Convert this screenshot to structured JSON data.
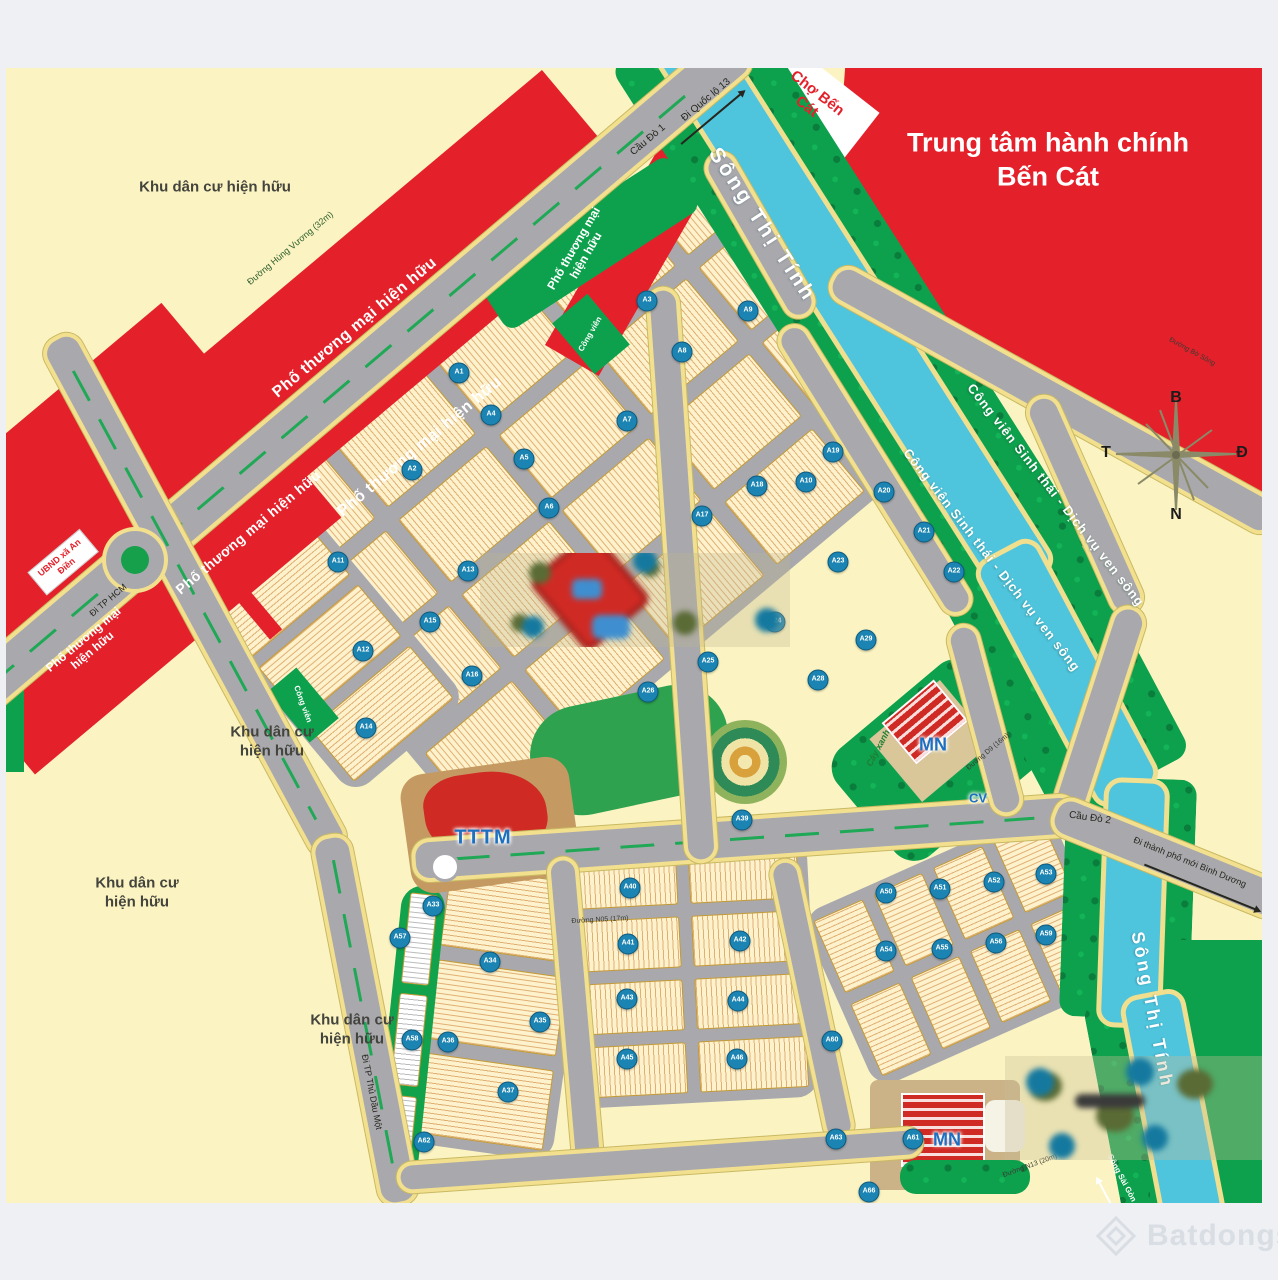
{
  "title": "Trung tâm hành chính Bến Cát",
  "labels": {
    "cho_ben_cat": "Chợ Bến Cát",
    "song_thi_tinh": "Sông Thị Tính",
    "song_sai_gon": "Sông Sài Gòn",
    "cong_vien_sinh_thai": "Công viên Sinh thái - Dịch vụ ven sông",
    "khu_dan_cu": "Khu dân cư hiện hữu",
    "pho_thuong_mai": "Phố thương mại hiện hữu",
    "ubnd": "UBND xã An Điền",
    "cong_vien": "Công viên",
    "cay_xanh": "Cây xanh",
    "tttm": "TTTM",
    "mn": "MN",
    "cv": "CV"
  },
  "roads": {
    "cau_do_1": "Cầu Đò 1",
    "di_quoc_lo_13": "Đi Quốc lộ 13",
    "cau_do_2": "Cầu Đò 2",
    "di_tpm_binh_duong": "Đi thành phố mới Bình Dương",
    "di_tp_hcm": "Đi TP HCM",
    "di_tp_thu_dau_mot": "Đi TP Thủ Dầu Một",
    "hung_vuong": "Đường Hùng Vương (32m)",
    "bo_song": "Đường Bờ Sông",
    "n05": "Đường N05 (17m)",
    "n13": "Đường N13 (20m)",
    "d9": "Đường D9 (16m)"
  },
  "compass": {
    "north": "B",
    "east": "Đ",
    "south": "N",
    "west": "T"
  },
  "watermark": "Batdongsan",
  "markers": [
    {
      "label": "A1",
      "x": 459,
      "y": 373
    },
    {
      "label": "A2",
      "x": 412,
      "y": 470
    },
    {
      "label": "A3",
      "x": 647,
      "y": 301
    },
    {
      "label": "A4",
      "x": 491,
      "y": 415
    },
    {
      "label": "A5",
      "x": 524,
      "y": 459
    },
    {
      "label": "A6",
      "x": 549,
      "y": 508
    },
    {
      "label": "A7",
      "x": 627,
      "y": 421
    },
    {
      "label": "A8",
      "x": 682,
      "y": 352
    },
    {
      "label": "A9",
      "x": 748,
      "y": 311
    },
    {
      "label": "A10",
      "x": 806,
      "y": 482
    },
    {
      "label": "A11",
      "x": 338,
      "y": 562
    },
    {
      "label": "A12",
      "x": 363,
      "y": 651
    },
    {
      "label": "A13",
      "x": 468,
      "y": 571
    },
    {
      "label": "A14",
      "x": 366,
      "y": 728
    },
    {
      "label": "A15",
      "x": 430,
      "y": 622
    },
    {
      "label": "A16",
      "x": 472,
      "y": 676
    },
    {
      "label": "A17",
      "x": 702,
      "y": 516
    },
    {
      "label": "A18",
      "x": 757,
      "y": 486
    },
    {
      "label": "A19",
      "x": 833,
      "y": 452
    },
    {
      "label": "A20",
      "x": 884,
      "y": 492
    },
    {
      "label": "A21",
      "x": 924,
      "y": 532
    },
    {
      "label": "A22",
      "x": 954,
      "y": 572
    },
    {
      "label": "A23",
      "x": 838,
      "y": 562
    },
    {
      "label": "A24",
      "x": 775,
      "y": 622
    },
    {
      "label": "A25",
      "x": 708,
      "y": 662
    },
    {
      "label": "A26",
      "x": 648,
      "y": 692
    },
    {
      "label": "A28",
      "x": 818,
      "y": 680
    },
    {
      "label": "A29",
      "x": 866,
      "y": 640
    },
    {
      "label": "A33",
      "x": 433,
      "y": 906
    },
    {
      "label": "A34",
      "x": 490,
      "y": 962
    },
    {
      "label": "A35",
      "x": 540,
      "y": 1022
    },
    {
      "label": "A36",
      "x": 448,
      "y": 1042
    },
    {
      "label": "A37",
      "x": 508,
      "y": 1092
    },
    {
      "label": "A39",
      "x": 742,
      "y": 820
    },
    {
      "label": "A40",
      "x": 630,
      "y": 888
    },
    {
      "label": "A41",
      "x": 628,
      "y": 944
    },
    {
      "label": "A42",
      "x": 740,
      "y": 941
    },
    {
      "label": "A43",
      "x": 627,
      "y": 999
    },
    {
      "label": "A44",
      "x": 738,
      "y": 1001
    },
    {
      "label": "A45",
      "x": 627,
      "y": 1059
    },
    {
      "label": "A46",
      "x": 737,
      "y": 1059
    },
    {
      "label": "A50",
      "x": 886,
      "y": 893
    },
    {
      "label": "A51",
      "x": 940,
      "y": 889
    },
    {
      "label": "A52",
      "x": 994,
      "y": 882
    },
    {
      "label": "A53",
      "x": 1046,
      "y": 874
    },
    {
      "label": "A54",
      "x": 886,
      "y": 951
    },
    {
      "label": "A55",
      "x": 942,
      "y": 949
    },
    {
      "label": "A56",
      "x": 996,
      "y": 943
    },
    {
      "label": "A59",
      "x": 1046,
      "y": 935
    },
    {
      "label": "A57",
      "x": 400,
      "y": 938
    },
    {
      "label": "A58",
      "x": 412,
      "y": 1040
    },
    {
      "label": "A62",
      "x": 424,
      "y": 1142
    },
    {
      "label": "A60",
      "x": 832,
      "y": 1041
    },
    {
      "label": "A61",
      "x": 913,
      "y": 1139
    },
    {
      "label": "A63",
      "x": 836,
      "y": 1139
    },
    {
      "label": "A66",
      "x": 869,
      "y": 1192
    }
  ]
}
